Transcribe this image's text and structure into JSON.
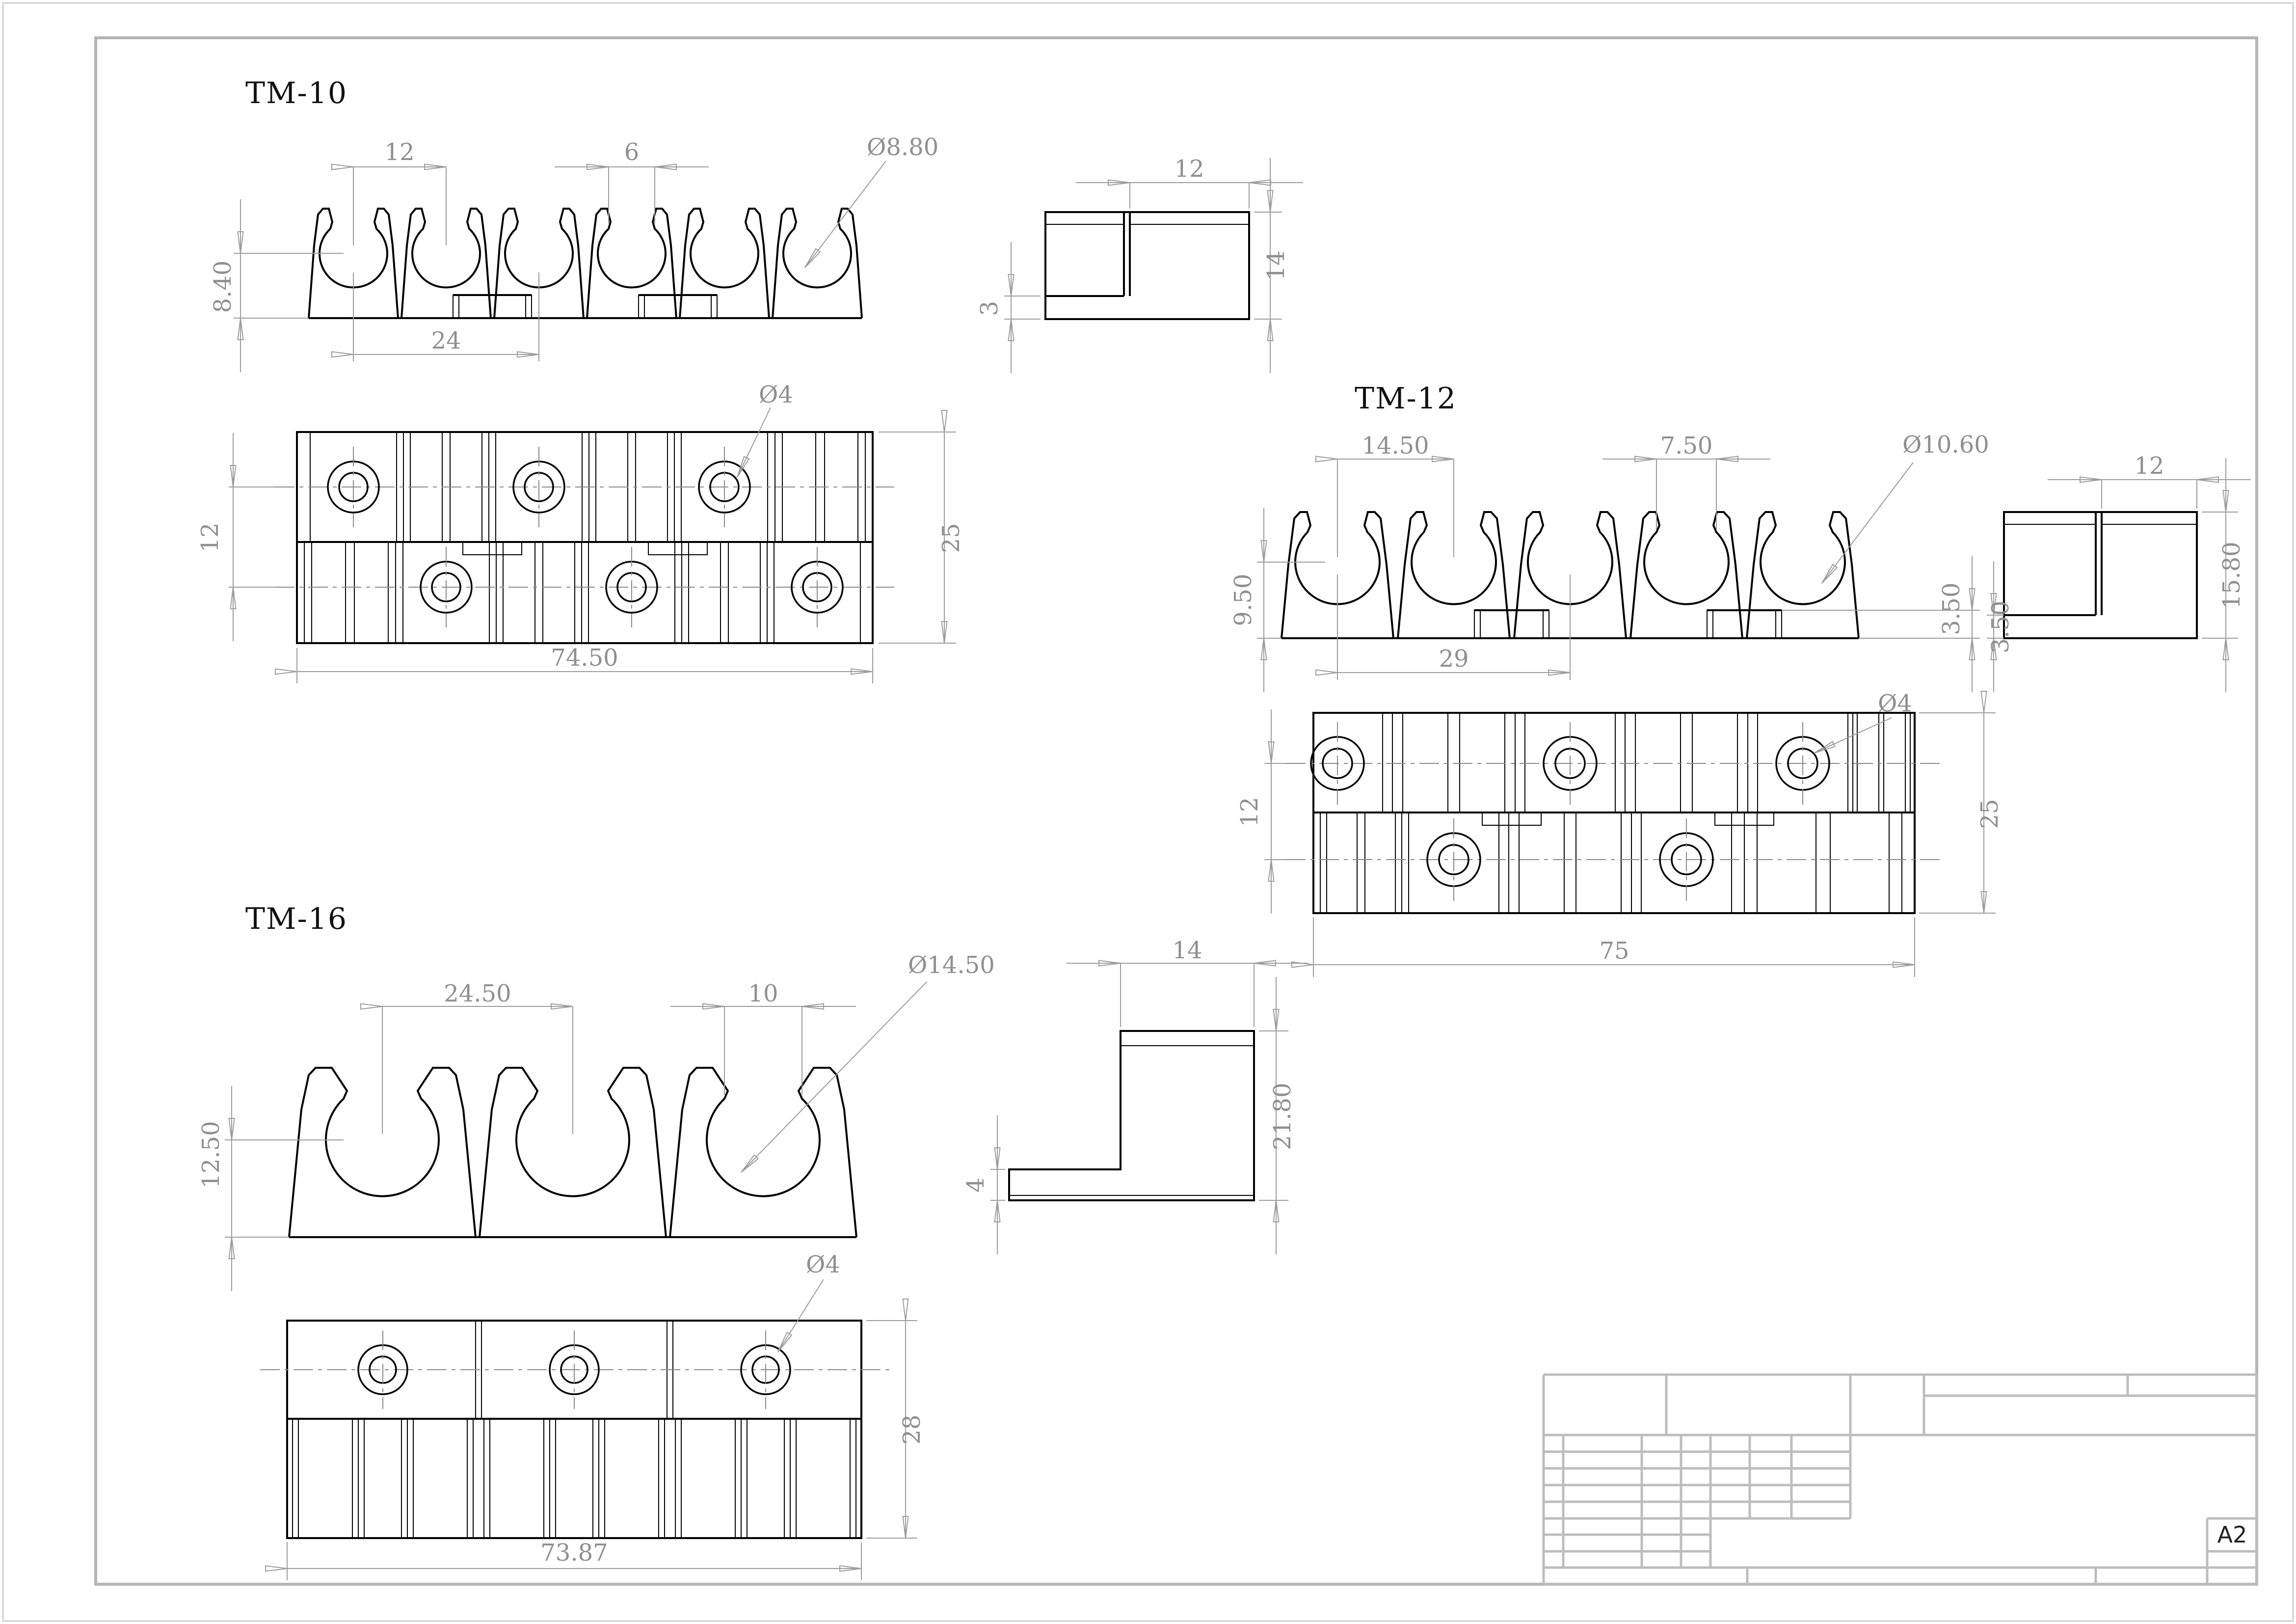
{
  "sheet": {
    "format_label": "A2"
  },
  "parts": [
    {
      "name": "TM-10",
      "front_view": {
        "pitch": "12",
        "mouth_width": "6",
        "center_height": "8.40",
        "double_pitch": "24",
        "bore_label": "Ø8.80"
      },
      "side_view": {
        "width": "12",
        "height": "14",
        "base_thickness": "3"
      },
      "plan_view": {
        "row_offset": "12",
        "depth": "25",
        "length": "74.50",
        "hole_label": "Ø4"
      }
    },
    {
      "name": "TM-12",
      "front_view": {
        "pitch": "14.50",
        "mouth_width": "7.50",
        "center_height": "9.50",
        "double_pitch": "29",
        "base_thickness": "3.50",
        "bore_label": "Ø10.60"
      },
      "side_view": {
        "width": "12",
        "height": "15.80",
        "base_thickness": "3.50"
      },
      "plan_view": {
        "row_offset": "12",
        "depth": "25",
        "length": "75",
        "hole_label": "Ø4"
      }
    },
    {
      "name": "TM-16",
      "front_view": {
        "pitch": "24.50",
        "mouth_width": "10",
        "center_height": "12.50",
        "bore_label": "Ø14.50"
      },
      "side_view": {
        "width": "14",
        "height": "21.80",
        "base_thickness": "4"
      },
      "plan_view": {
        "depth": "28",
        "length": "73.87",
        "hole_label": "Ø4"
      }
    }
  ]
}
